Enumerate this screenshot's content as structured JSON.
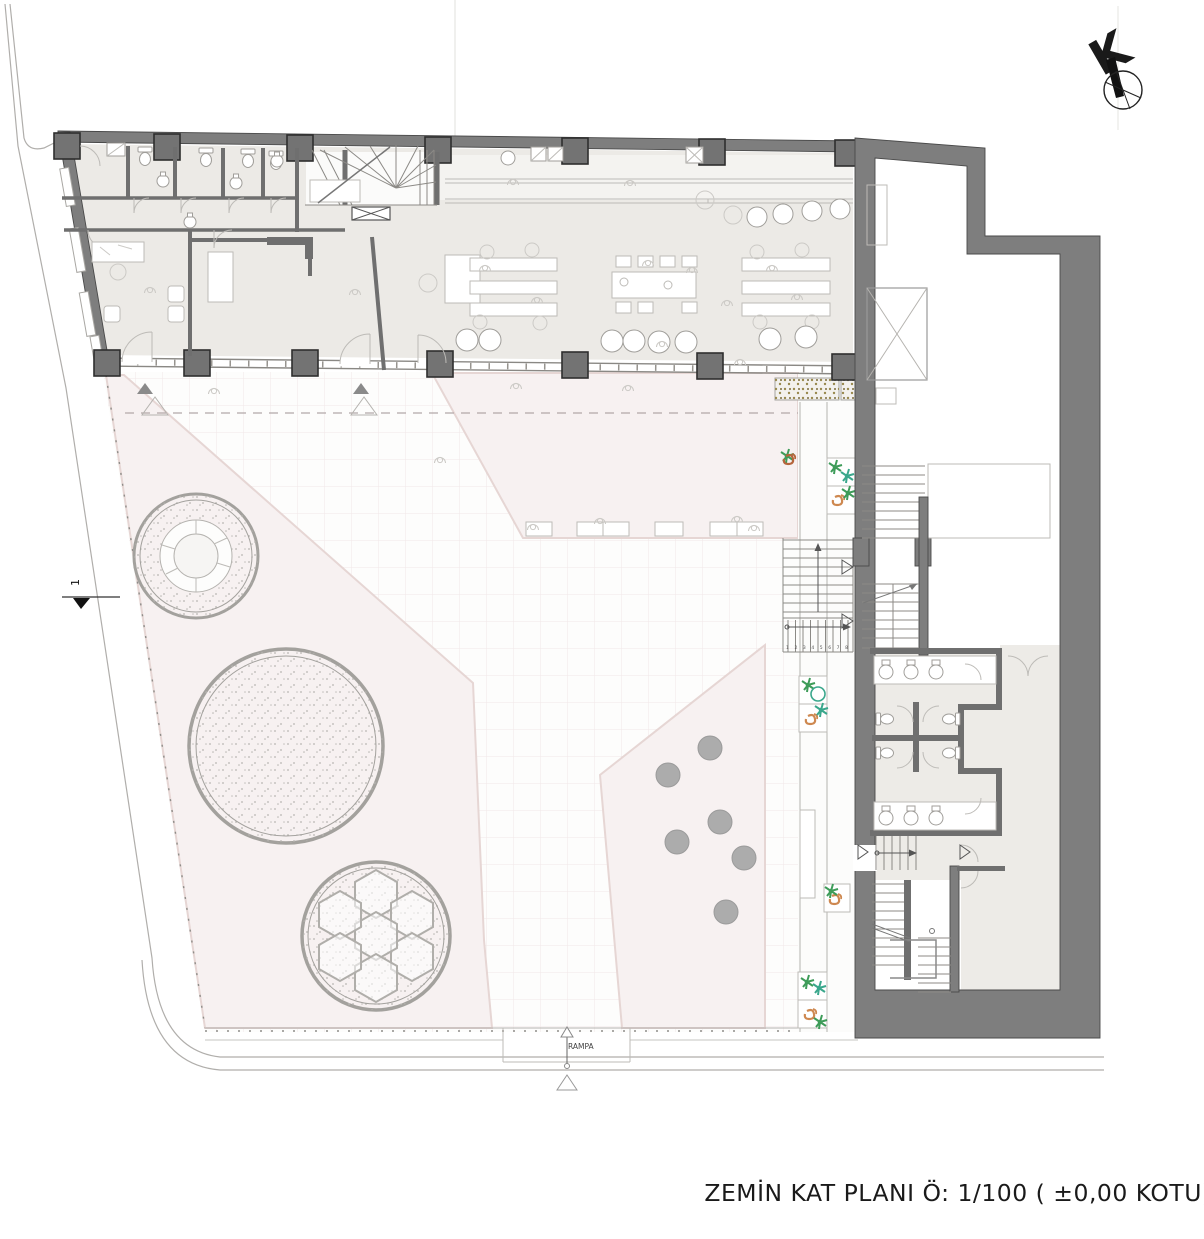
{
  "plan": {
    "title": "ZEMİN KAT PLANI Ö: 1/100 ( ±0,00 KOTU)",
    "north_label": "K",
    "ramp_label": "RAMPA",
    "section_label": "1",
    "stair_steps": "1 2 3 4 5 6 7 8"
  },
  "colors": {
    "paper": "#FFFFFF",
    "floor": "#ECEAE6",
    "floor2": "#EDEBE7",
    "wall": "#7E7E7E",
    "wall_outline": "#4A4A4A",
    "partition": "#6F6F6F",
    "column": "#737373",
    "column_outline": "#2E2E2E",
    "window_line": "#97948F",
    "furniture_line": "#BDBBB7",
    "sketch_line": "#CCCAC6",
    "pink": "#F7F1F1",
    "pink_edge": "#E6D6D4",
    "plaza": "#FDFDFC",
    "grid": "#F1E8E8",
    "dot_gray": "#ACACAC",
    "ring_gray": "#A3A19D",
    "stair_line": "#8C8A86",
    "plant_green": "#3E9C59",
    "plant_teal": "#3AA78C",
    "plant_orange": "#CE8850",
    "plant_rust": "#B5653C",
    "gravel_olive": "#99894E",
    "ink": "#1A1A1A"
  }
}
